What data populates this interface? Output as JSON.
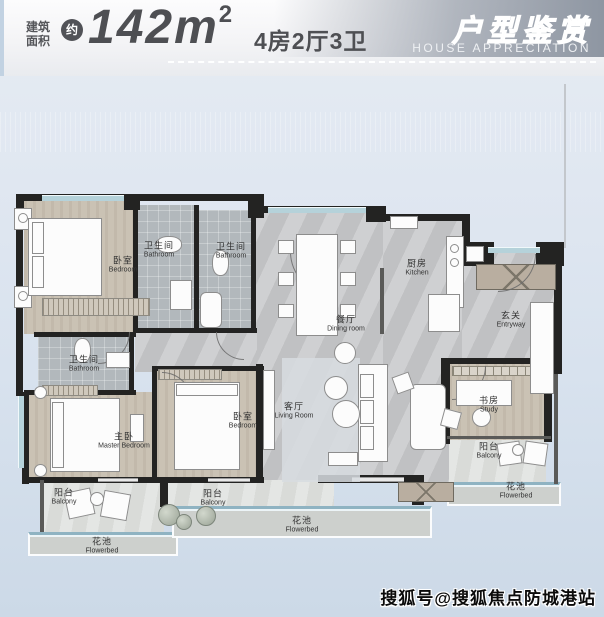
{
  "header": {
    "area_label_top": "建筑",
    "area_label_bottom": "面积",
    "approx": "约",
    "area_value": "142m",
    "area_exponent": "2",
    "layout_summary": "4房2厅3卫",
    "banner_cn": "户型鉴赏",
    "banner_en": "HOUSE APPRECIATION"
  },
  "watermark": "搜狐号@搜狐焦点防城港站",
  "floorplan": {
    "rooms": [
      {
        "id": "bedroom-top",
        "cn": "卧室",
        "en": "Bedroom",
        "x": 123,
        "y": 265
      },
      {
        "id": "bathroom-top-1",
        "cn": "卫生间",
        "en": "Bathroom",
        "x": 159,
        "y": 250
      },
      {
        "id": "bathroom-top-2",
        "cn": "卫生间",
        "en": "Bathroom",
        "x": 231,
        "y": 251
      },
      {
        "id": "dining-room",
        "cn": "餐厅",
        "en": "Dining room",
        "x": 346,
        "y": 324
      },
      {
        "id": "kitchen",
        "cn": "厨房",
        "en": "Kitchen",
        "x": 417,
        "y": 268
      },
      {
        "id": "entryway",
        "cn": "玄关",
        "en": "Entryway",
        "x": 511,
        "y": 320
      },
      {
        "id": "bathroom-master",
        "cn": "卫生间",
        "en": "Bathroom",
        "x": 84,
        "y": 364
      },
      {
        "id": "master-bedroom",
        "cn": "主卧",
        "en": "Master Bedroom",
        "x": 124,
        "y": 441
      },
      {
        "id": "bedroom-bottom",
        "cn": "卧室",
        "en": "Bedroom",
        "x": 243,
        "y": 421
      },
      {
        "id": "living-room",
        "cn": "客厅",
        "en": "Living Room",
        "x": 294,
        "y": 411
      },
      {
        "id": "study",
        "cn": "书房",
        "en": "Study",
        "x": 489,
        "y": 405
      },
      {
        "id": "balcony-right",
        "cn": "阳台",
        "en": "Balcony",
        "x": 489,
        "y": 451
      },
      {
        "id": "flowerbed-right",
        "cn": "花池",
        "en": "Flowerbed",
        "x": 516,
        "y": 491
      },
      {
        "id": "balcony-left",
        "cn": "阳台",
        "en": "Balcony",
        "x": 64,
        "y": 497
      },
      {
        "id": "flowerbed-left",
        "cn": "花池",
        "en": "Flowerbed",
        "x": 102,
        "y": 546
      },
      {
        "id": "balcony-middle",
        "cn": "阳台",
        "en": "Balcony",
        "x": 213,
        "y": 498
      },
      {
        "id": "flowerbed-middle",
        "cn": "花池",
        "en": "Flowerbed",
        "x": 302,
        "y": 525
      }
    ],
    "colors": {
      "wall": "#232322",
      "window": "#b5d2da",
      "flower_strip": "#8fb3c2",
      "accent_text": "#4e4f53",
      "banner_band": "#8e96a2"
    }
  }
}
